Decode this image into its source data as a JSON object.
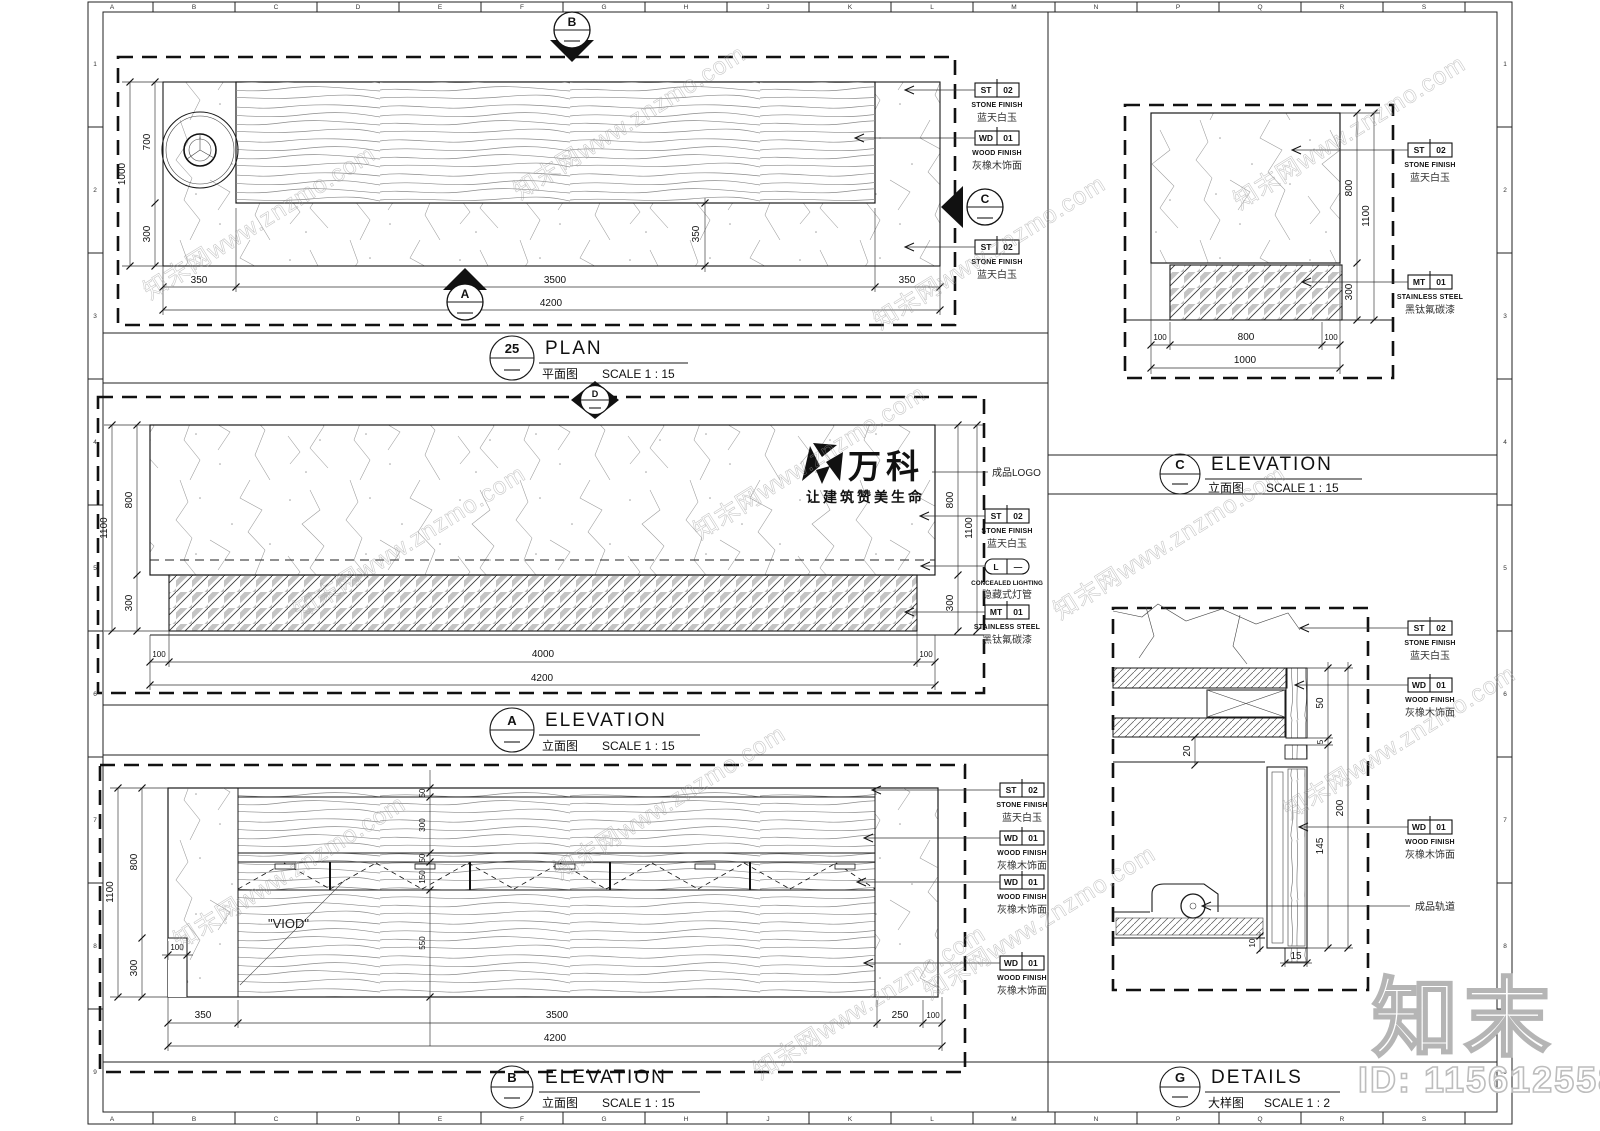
{
  "watermark": {
    "tile": "知末网www.znzmo.com",
    "big": "知末",
    "id_label": "ID: 1156125582"
  },
  "frame": {
    "top_letters": [
      "A",
      "B",
      "C",
      "D",
      "E",
      "F",
      "G",
      "H",
      "J",
      "K",
      "L",
      "M",
      "N",
      "P",
      "Q",
      "R",
      "S"
    ],
    "left_numbers": [
      "1",
      "2",
      "3",
      "4",
      "5",
      "6",
      "7",
      "8",
      "9"
    ]
  },
  "materials": {
    "st02": {
      "code": "ST",
      "num": "02",
      "en": "STONE FINISH",
      "cn": "蓝天白玉"
    },
    "wd01": {
      "code": "WD",
      "num": "01",
      "en": "WOOD FINISH",
      "cn": "灰橡木饰面"
    },
    "mt01": {
      "code": "MT",
      "num": "01",
      "en": "STAINLESS STEEL",
      "cn": "黑钛氟碳漆"
    },
    "light": {
      "code": "L",
      "num": "—",
      "en": "CONCEALED LIGHTING",
      "cn": "隐藏式灯管"
    },
    "logo_note": "成品LOGO",
    "track_note": "成品轨道"
  },
  "logo": {
    "name": "万科",
    "slogan": "让建筑赞美生命"
  },
  "markers": {
    "a": "A",
    "b": "B",
    "c": "C",
    "d": "D"
  },
  "views": {
    "plan": {
      "num": "25",
      "title": "PLAN",
      "cn": "平面图",
      "scale": "SCALE 1 : 15",
      "dims": {
        "d1000": "1000",
        "d700": "700",
        "d300": "300",
        "d350": "350",
        "d3500": "3500",
        "d4200": "4200"
      }
    },
    "elev_a": {
      "num": "A",
      "title": "ELEVATION",
      "cn": "立面图",
      "scale": "SCALE 1 : 15",
      "dims": {
        "d1100": "1100",
        "d800": "800",
        "d300": "300",
        "d100": "100",
        "d4000": "4000",
        "d4200": "4200"
      }
    },
    "elev_b": {
      "num": "B",
      "title": "ELEVATION",
      "cn": "立面图",
      "scale": "SCALE 1 : 15",
      "void_label": "\"VIOD\"",
      "dims": {
        "d1100": "1100",
        "d800": "800",
        "d300": "300",
        "d100": "100",
        "d50": "50",
        "d150": "150",
        "d550": "550",
        "d350": "350",
        "d3500": "3500",
        "d250": "250",
        "d4200": "4200"
      }
    },
    "elev_c": {
      "num": "C",
      "title": "ELEVATION",
      "cn": "立面图",
      "scale": "SCALE 1 : 15",
      "dims": {
        "d800": "800",
        "d1100": "1100",
        "d300": "300",
        "d100": "100",
        "d1000": "1000"
      }
    },
    "detail_g": {
      "num": "G",
      "title": "DETAILS",
      "cn": "大样图",
      "scale": "SCALE 1 : 2",
      "dims": {
        "d50": "50",
        "d5": "5",
        "d20": "20",
        "d200": "200",
        "d145": "145",
        "d10": "10",
        "d15": "15"
      }
    }
  }
}
